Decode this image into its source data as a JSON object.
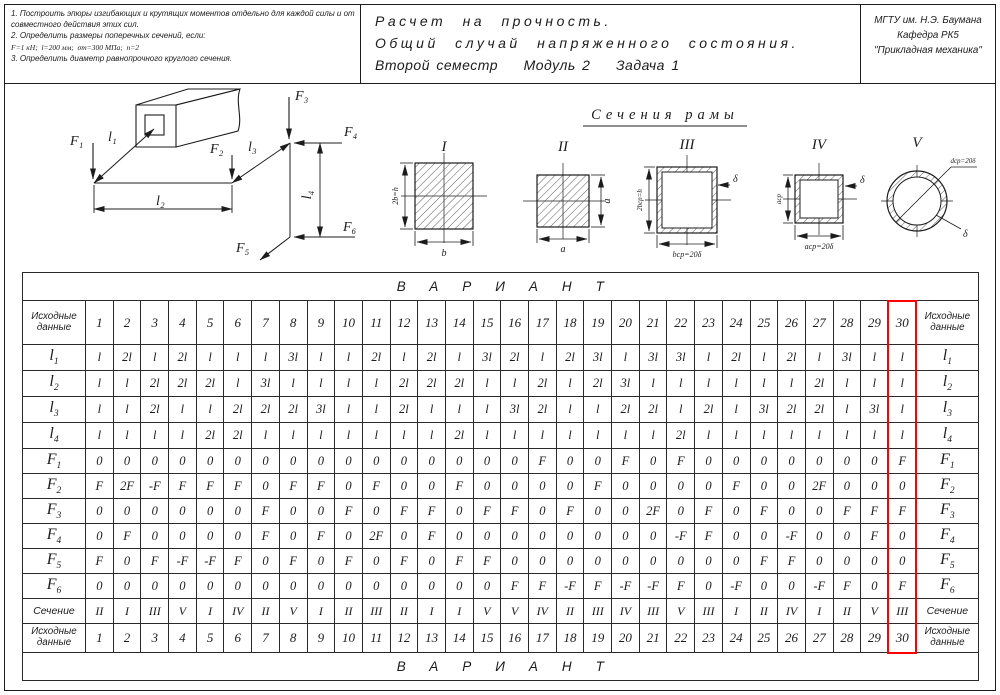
{
  "header": {
    "tasks": [
      "1. Построить эпюры изгибающих и крутящих моментов отдельно для каждой силы и от совместного действия этих сил.",
      "2. Определить размеры поперечных сечений, если:",
      "F=1 кН;  l=200 мм;  σт=300 МПа;  n=2",
      "3. Определить диаметр равнопрочного круглого сечения."
    ],
    "title_lines": [
      "Расчет на прочность.",
      "Общий случай напряженного состояния.",
      "Второй семестр    Модуль 2    Задача 1"
    ],
    "org_lines": [
      "МГТУ им. Н.Э. Баумана",
      "Кафедра РК5",
      "\"Прикладная механика\""
    ]
  },
  "diagram": {
    "forces": [
      "F₁",
      "F₂",
      "F₃",
      "F₄",
      "F₅",
      "F₆"
    ],
    "lengths": [
      "l₁",
      "l₂",
      "l₃",
      "l₄"
    ]
  },
  "sections": {
    "title": "Сечения рамы",
    "items": [
      {
        "numeral": "I",
        "dims": [
          "2b=h",
          "b"
        ]
      },
      {
        "numeral": "II",
        "dims": [
          "a",
          "a"
        ]
      },
      {
        "numeral": "III",
        "dims": [
          "2bср=h",
          "bср=20δ",
          "δ"
        ]
      },
      {
        "numeral": "IV",
        "dims": [
          "aср",
          "aср=20δ",
          "δ"
        ]
      },
      {
        "numeral": "V",
        "dims": [
          "dср=20δ",
          "δ"
        ]
      }
    ]
  },
  "table": {
    "variant_banner": "ВАРИАНТ",
    "corner_label": "Исходные данные",
    "highlight_variant": 30,
    "variants": [
      1,
      2,
      3,
      4,
      5,
      6,
      7,
      8,
      9,
      10,
      11,
      12,
      13,
      14,
      15,
      16,
      17,
      18,
      19,
      20,
      21,
      22,
      23,
      24,
      25,
      26,
      27,
      28,
      29,
      30
    ],
    "rows": [
      {
        "base": "l",
        "sub": "1",
        "values": [
          "l",
          "2l",
          "l",
          "2l",
          "l",
          "l",
          "l",
          "3l",
          "l",
          "l",
          "2l",
          "l",
          "2l",
          "l",
          "3l",
          "2l",
          "l",
          "2l",
          "3l",
          "l",
          "3l",
          "3l",
          "l",
          "2l",
          "l",
          "2l",
          "l",
          "3l",
          "l",
          "l"
        ]
      },
      {
        "base": "l",
        "sub": "2",
        "values": [
          "l",
          "l",
          "2l",
          "2l",
          "2l",
          "l",
          "3l",
          "l",
          "l",
          "l",
          "l",
          "2l",
          "2l",
          "2l",
          "l",
          "l",
          "2l",
          "l",
          "2l",
          "3l",
          "l",
          "l",
          "l",
          "l",
          "l",
          "l",
          "2l",
          "l",
          "l",
          "l"
        ]
      },
      {
        "base": "l",
        "sub": "3",
        "values": [
          "l",
          "l",
          "2l",
          "l",
          "l",
          "2l",
          "2l",
          "2l",
          "3l",
          "l",
          "l",
          "2l",
          "l",
          "l",
          "l",
          "3l",
          "2l",
          "l",
          "l",
          "2l",
          "2l",
          "l",
          "2l",
          "l",
          "3l",
          "2l",
          "2l",
          "l",
          "3l",
          "l"
        ]
      },
      {
        "base": "l",
        "sub": "4",
        "values": [
          "l",
          "l",
          "l",
          "l",
          "2l",
          "2l",
          "l",
          "l",
          "l",
          "l",
          "l",
          "l",
          "l",
          "2l",
          "l",
          "l",
          "l",
          "l",
          "l",
          "l",
          "l",
          "2l",
          "l",
          "l",
          "l",
          "l",
          "l",
          "l",
          "l",
          "l"
        ]
      },
      {
        "base": "F",
        "sub": "1",
        "values": [
          "0",
          "0",
          "0",
          "0",
          "0",
          "0",
          "0",
          "0",
          "0",
          "0",
          "0",
          "0",
          "0",
          "0",
          "0",
          "0",
          "F",
          "0",
          "0",
          "F",
          "0",
          "F",
          "0",
          "0",
          "0",
          "0",
          "0",
          "0",
          "0",
          "F"
        ]
      },
      {
        "base": "F",
        "sub": "2",
        "values": [
          "F",
          "2F",
          "-F",
          "F",
          "F",
          "F",
          "0",
          "F",
          "F",
          "0",
          "F",
          "0",
          "0",
          "F",
          "0",
          "0",
          "0",
          "0",
          "F",
          "0",
          "0",
          "0",
          "0",
          "F",
          "0",
          "0",
          "2F",
          "0",
          "0",
          "0"
        ]
      },
      {
        "base": "F",
        "sub": "3",
        "values": [
          "0",
          "0",
          "0",
          "0",
          "0",
          "0",
          "F",
          "0",
          "0",
          "F",
          "0",
          "F",
          "F",
          "0",
          "F",
          "F",
          "0",
          "F",
          "0",
          "0",
          "2F",
          "0",
          "F",
          "0",
          "F",
          "0",
          "0",
          "F",
          "F",
          "F"
        ]
      },
      {
        "base": "F",
        "sub": "4",
        "values": [
          "0",
          "F",
          "0",
          "0",
          "0",
          "0",
          "F",
          "0",
          "F",
          "0",
          "2F",
          "0",
          "F",
          "0",
          "0",
          "0",
          "0",
          "0",
          "0",
          "0",
          "0",
          "-F",
          "F",
          "0",
          "0",
          "-F",
          "0",
          "0",
          "F",
          "0"
        ]
      },
      {
        "base": "F",
        "sub": "5",
        "values": [
          "F",
          "0",
          "F",
          "-F",
          "-F",
          "F",
          "0",
          "F",
          "0",
          "F",
          "0",
          "F",
          "0",
          "F",
          "F",
          "0",
          "0",
          "0",
          "0",
          "0",
          "0",
          "0",
          "0",
          "0",
          "F",
          "F",
          "0",
          "0",
          "0",
          "0"
        ]
      },
      {
        "base": "F",
        "sub": "6",
        "values": [
          "0",
          "0",
          "0",
          "0",
          "0",
          "0",
          "0",
          "0",
          "0",
          "0",
          "0",
          "0",
          "0",
          "0",
          "0",
          "F",
          "F",
          "-F",
          "F",
          "-F",
          "-F",
          "F",
          "0",
          "-F",
          "0",
          "0",
          "-F",
          "F",
          "0",
          "F"
        ]
      }
    ],
    "section_row": {
      "label": "Сечение",
      "values": [
        "II",
        "I",
        "III",
        "V",
        "I",
        "IV",
        "II",
        "V",
        "I",
        "II",
        "III",
        "II",
        "I",
        "I",
        "V",
        "V",
        "IV",
        "II",
        "III",
        "IV",
        "III",
        "V",
        "III",
        "I",
        "II",
        "IV",
        "I",
        "II",
        "V",
        "III"
      ]
    }
  }
}
